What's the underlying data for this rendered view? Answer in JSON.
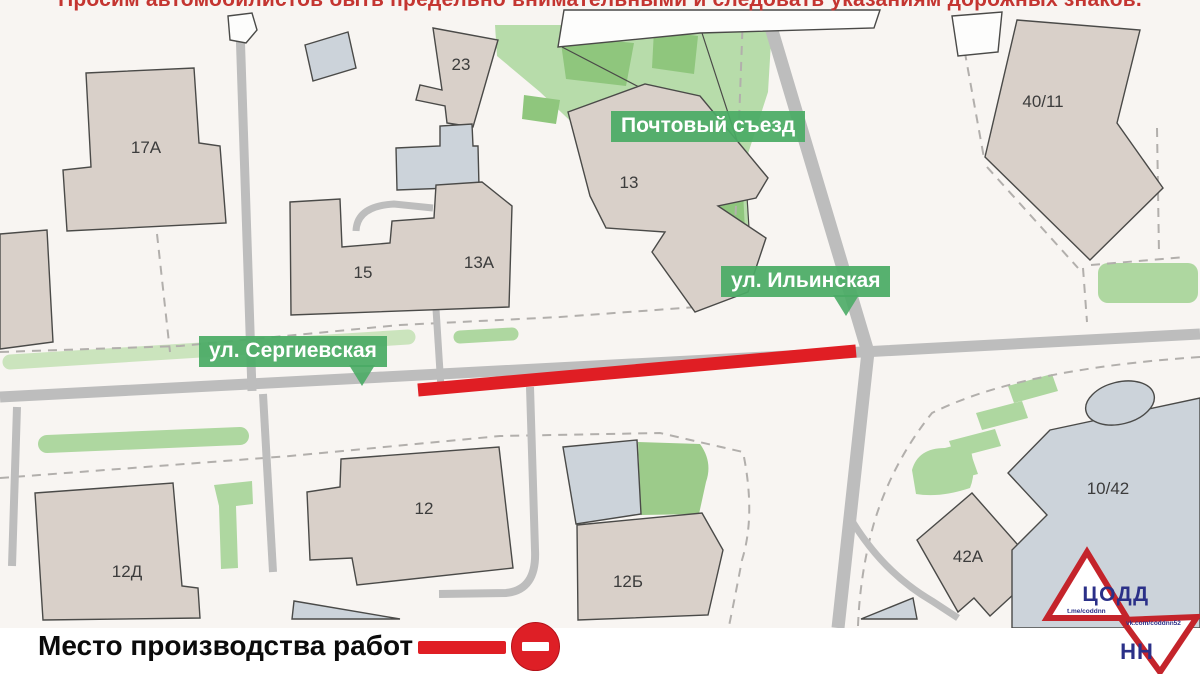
{
  "warning": {
    "text": "Просим автомобилистов быть предельно внимательными и следовать указаниям дорожных знаков."
  },
  "streets": {
    "pochtovy": "Почтовый съезд",
    "ilyinskaya": "ул. Ильинская",
    "sergievskaya": "ул. Сергиевская"
  },
  "buildings": [
    {
      "label": "17А"
    },
    {
      "label": "23"
    },
    {
      "label": "13"
    },
    {
      "label": "15"
    },
    {
      "label": "13А"
    },
    {
      "label": "40/11"
    },
    {
      "label": "12Д"
    },
    {
      "label": "12"
    },
    {
      "label": "12Б"
    },
    {
      "label": "42А"
    },
    {
      "label": "10/42"
    }
  ],
  "legend": {
    "text": "Место производства работ  -"
  },
  "logo": {
    "org": "ЦОДД",
    "city": "НН",
    "telegram": "t.me/coddnn",
    "vk": "vk.com/coddnn52"
  },
  "colors": {
    "closure_red": "#e01e24",
    "street_badge_green": "#4aab65",
    "building_beige": "#d9d0c9",
    "building_gray": "#ccd3da",
    "green_area": "#aed7a0",
    "park_green": "#b7dcaa",
    "road_gray": "#bdbdbd",
    "warning_red": "#c43531",
    "logo_red": "#c4242b",
    "logo_blue": "#2b3088"
  }
}
